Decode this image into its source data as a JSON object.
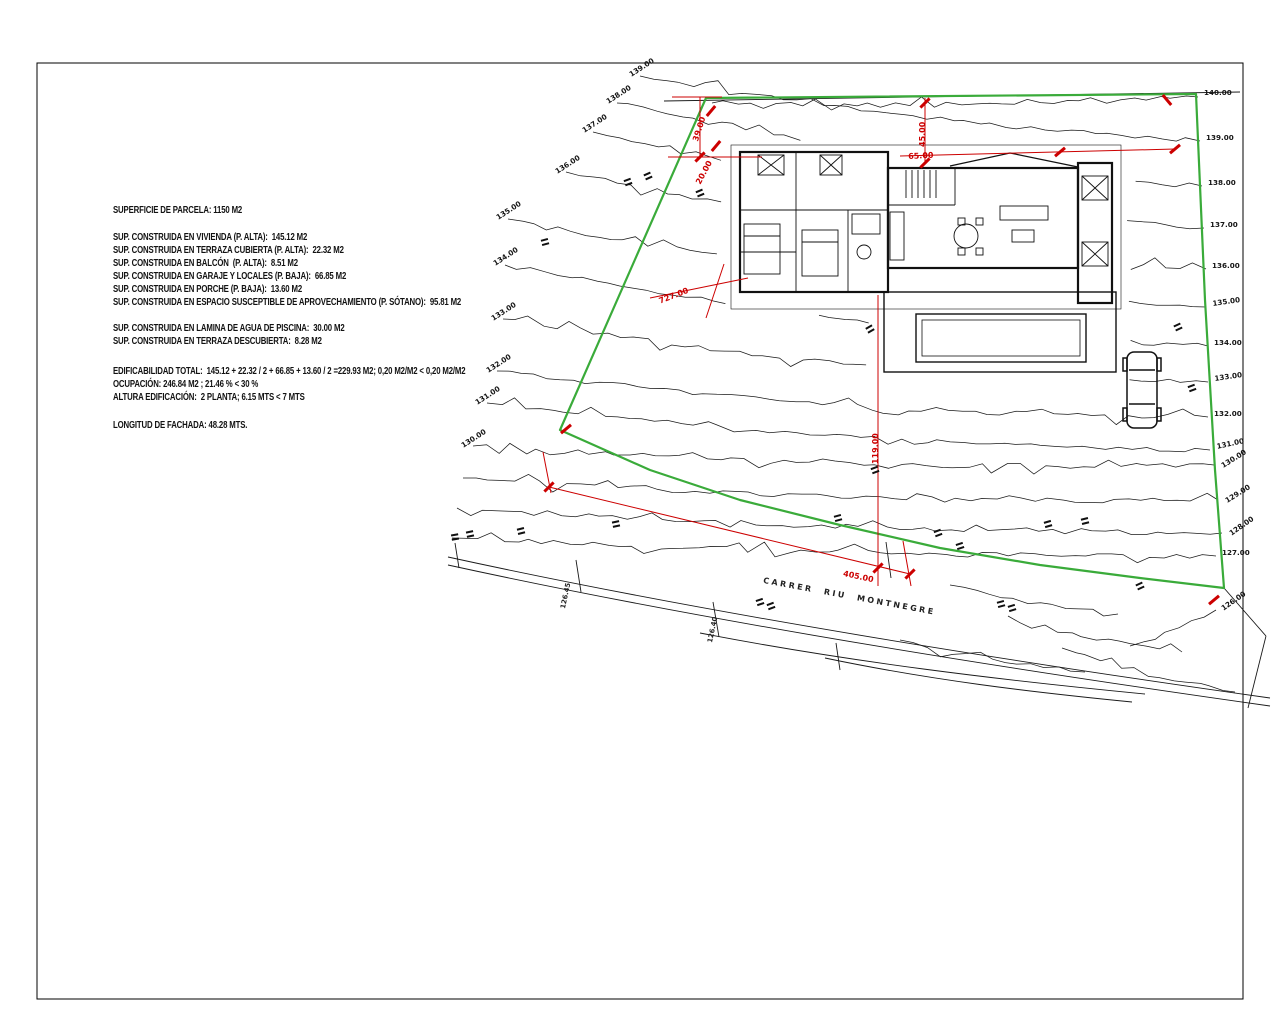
{
  "info_panel": {
    "lines": [
      "SUPERFICIE DE PARCELA: 1150 M2",
      "SUP. CONSTRUIDA EN VIVIENDA (P. ALTA):  145.12 M2",
      "SUP. CONSTRUIDA EN TERRAZA CUBIERTA (P. ALTA):  22.32 M2",
      "SUP. CONSTRUIDA EN BALCÓN  (P. ALTA):  8.51 M2",
      "SUP. CONSTRUIDA EN GARAJE Y LOCALES (P. BAJA):  66.85 M2",
      "SUP. CONSTRUIDA EN PORCHE (P. BAJA):  13.60 M2",
      "SUP. CONSTRUIDA EN ESPACIO SUSCEPTIBLE DE APROVECHAMIENTO (P. SÓTANO):  95.81 M2",
      "SUP. CONSTRUIDA EN LAMINA DE AGUA DE PISCINA:  30.00 M2",
      "SUP. CONSTRUIDA EN TERRAZA DESCUBIERTA:  8.28 M2",
      "EDIFICABILIDAD TOTAL:  145.12 + 22.32 / 2 + 66.85 + 13.60 / 2 =229.93 M2; 0,20 M2/M2 < 0,20 M2/M2",
      "OCUPACIÓN: 246.84 M2 ; 21.46 % < 30 %",
      "ALTURA EDIFICACIÓN:  2 PLANTA; 6.15 MTS < 7 MTS",
      "LONGITUD DE FACHADA: 48.28 MTS."
    ]
  },
  "street": {
    "name": "CARRER  RIU  MONTNEGRE"
  },
  "contour_labels": {
    "right": [
      "140.00",
      "139.00",
      "138.00",
      "137.00",
      "136.00",
      "135.00",
      "134.00",
      "133.00",
      "132.00",
      "131.00",
      "130.00",
      "129.00",
      "128.00",
      "127.00",
      "126.00"
    ],
    "left": [
      "139.00",
      "138.00",
      "137.00",
      "136.00",
      "135.00",
      "134.00",
      "133.00",
      "132.00",
      "131.00",
      "130.00"
    ]
  },
  "dimension_labels": [
    "39.00",
    "20.00",
    "45.00",
    "65.00",
    "727.00",
    "119.00",
    "405.00"
  ],
  "spot_elevations": [
    "126.45",
    "126.40"
  ],
  "colors": {
    "boundary_green": "#3aab3a",
    "dimension_red": "#cc0000",
    "linework_black": "#1a1a1a",
    "paper": "#ffffff"
  }
}
